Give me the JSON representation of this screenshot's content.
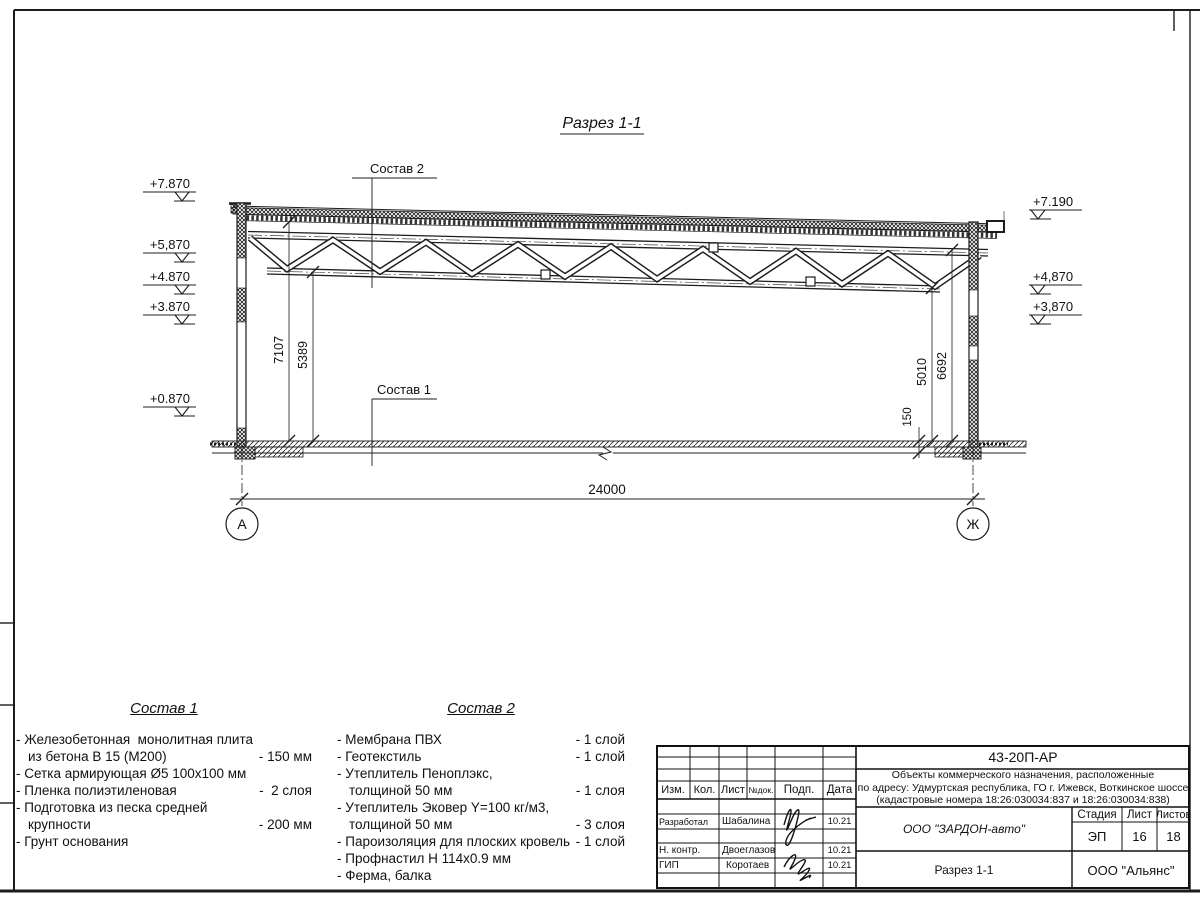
{
  "drawing": {
    "title": "Разрез 1-1",
    "span_dim": "24000",
    "axis_left": "А",
    "axis_right": "Ж",
    "elev_left": [
      "+7.870",
      "+5,870",
      "+4.870",
      "+3.870",
      "+0.870"
    ],
    "elev_right": [
      "+7.190",
      "+4,870",
      "+3,870"
    ],
    "vdim_left": [
      "7107",
      "5389"
    ],
    "vdim_right": [
      "5010",
      "6692"
    ],
    "slab_dim": "150"
  },
  "sostav1": {
    "title": "Состав 1",
    "items": [
      {
        "l1": "- Железобетонная  монолитная плита",
        "l2": "из бетона В 15 (М200)",
        "v": "- 150 мм"
      },
      {
        "l1": "- Сетка армирующая Ø5 100х100 мм"
      },
      {
        "l1": "- Пленка полиэтиленовая",
        "v": "-  2 слоя"
      },
      {
        "l1": "- Подготовка из песка средней",
        "l2": "крупности",
        "v": "- 200 мм"
      },
      {
        "l1": "- Грунт основания"
      }
    ]
  },
  "sostav2": {
    "title": "Состав 2",
    "items": [
      {
        "l1": "- Мембрана ПВХ",
        "v": "- 1 слой"
      },
      {
        "l1": "- Геотекстиль",
        "v": "- 1 слой"
      },
      {
        "l1": "- Утеплитель Пеноплэкс,",
        "l2": "толщиной 50 мм",
        "v": "- 1 слоя"
      },
      {
        "l1": "- Утеплитель Эковер Y=100 кг/м3,",
        "l2": "толщиной 50 мм",
        "v": "- 3 слоя"
      },
      {
        "l1": "- Пароизоляция для плоских кровель",
        "v": "- 1 слой"
      },
      {
        "l1": "- Профнастил Н 114х0.9 мм"
      },
      {
        "l1": "- Ферма, балка"
      }
    ]
  },
  "titleblock": {
    "doc_code": "43-20П-АР",
    "project_line1": "Объекты коммерческого назначения, расположенные",
    "project_line2": "по адресу: Удмуртская республика, ГО г. Ижевск, Воткинское шоссе",
    "project_line3": "(кадастровые номера 18:26:030034:837 и 18:26:030034:838)",
    "col_izm": "Изм.",
    "col_kol": "Кол.",
    "col_list": "Лист",
    "col_ndok": "№док.",
    "col_podp": "Подп.",
    "col_data": "Дата",
    "row_razrabotal": {
      "role": "Разработал",
      "name": "Шабалина",
      "date": "10.21"
    },
    "row_nkontr": {
      "role": "Н. контр.",
      "name": "Двоеглазов",
      "date": "10.21"
    },
    "row_gip": {
      "role": "ГИП",
      "name": "Коротаев",
      "date": "10.21"
    },
    "company": "ООО \"ЗАРДОН-авто\"",
    "stage_label": "Стадия",
    "sheet_label": "Лист",
    "sheets_label": "Листов",
    "stage": "ЭП",
    "sheet": "16",
    "sheets": "18",
    "sheet_title": "Разрез 1-1",
    "contractor": "ООО \"Альянс\""
  }
}
